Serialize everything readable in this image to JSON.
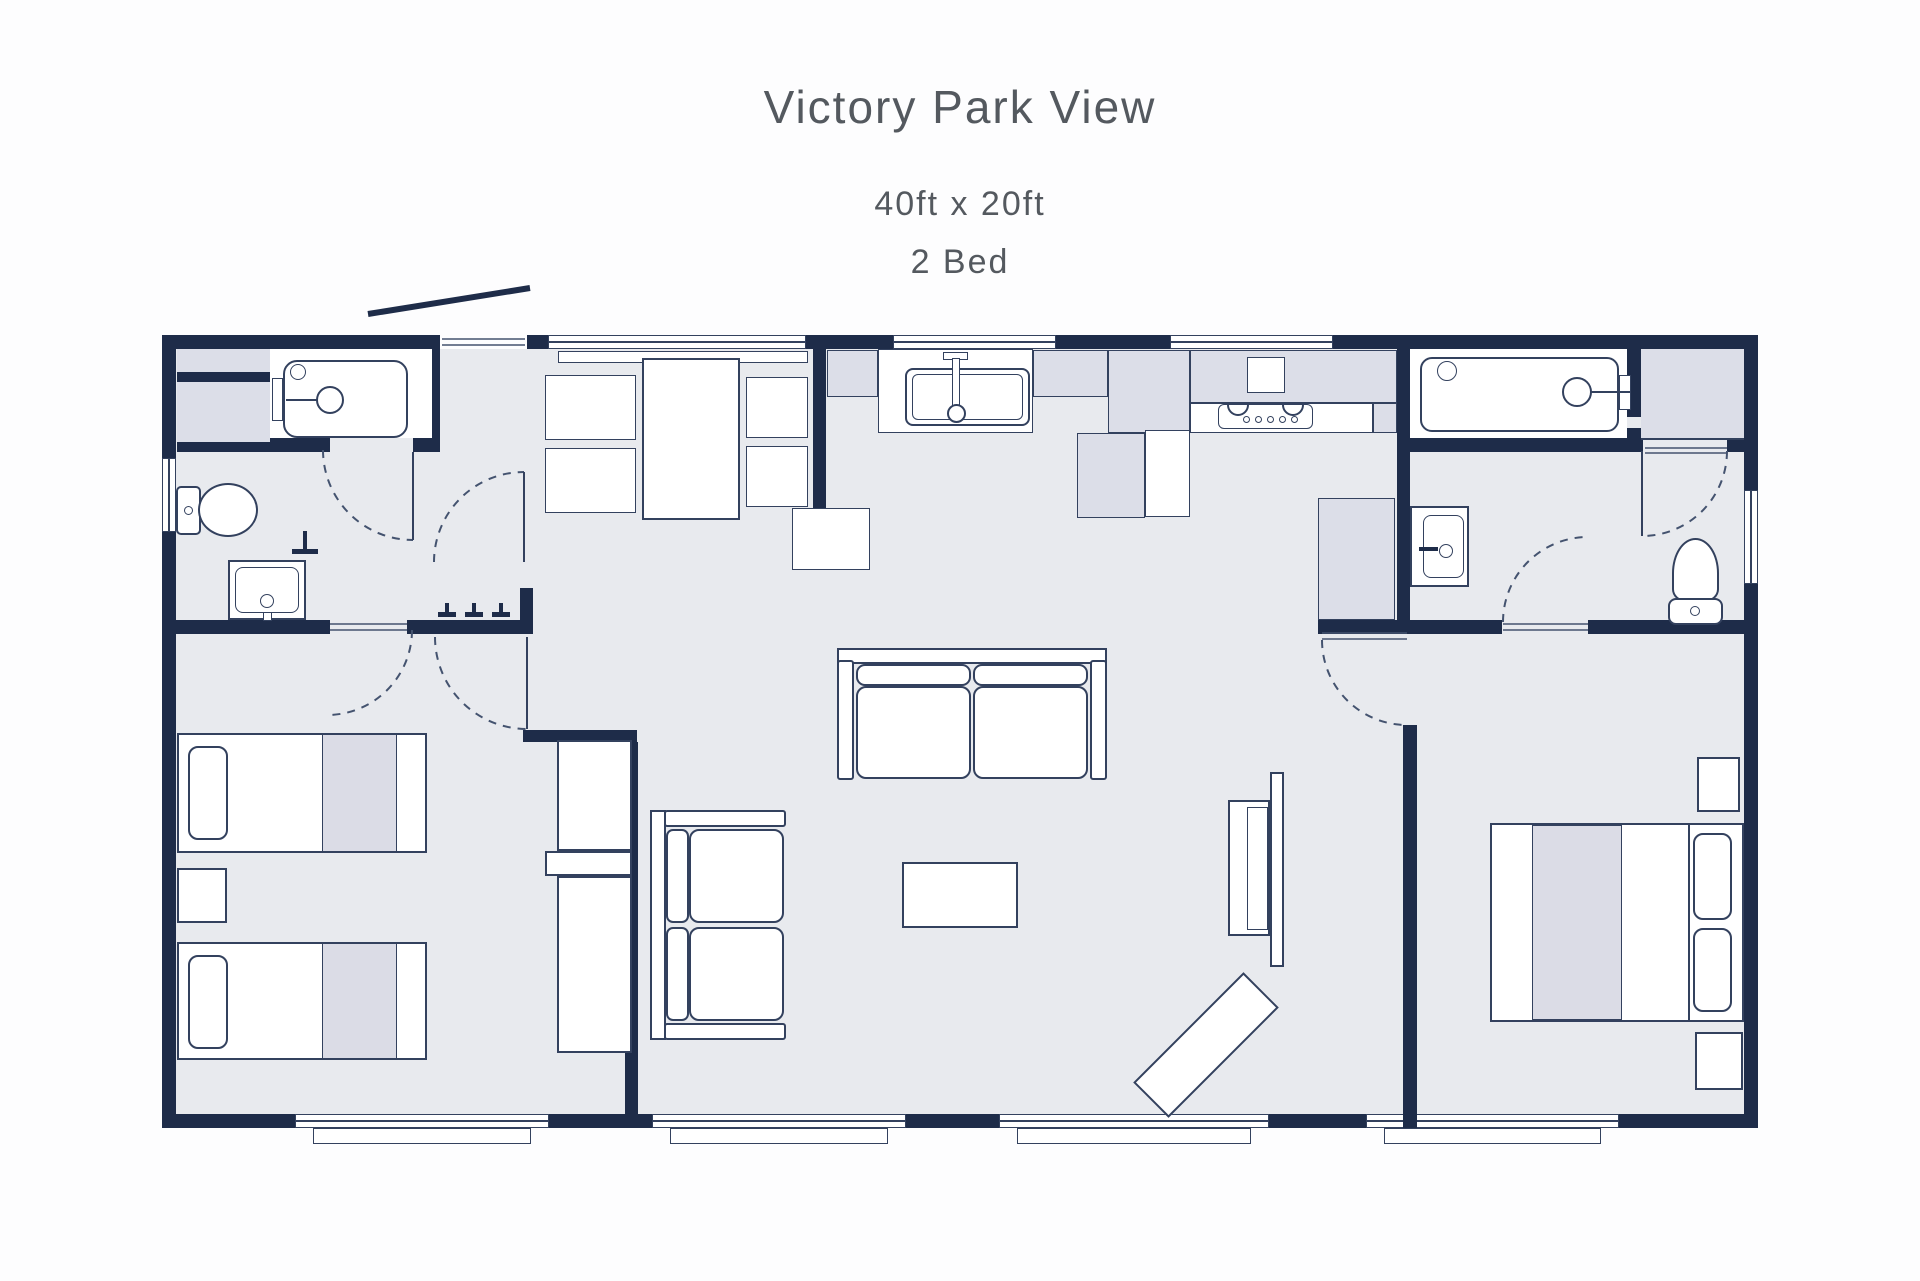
{
  "header": {
    "title": "Victory Park View",
    "dimensions": "40ft x 20ft",
    "bedrooms": "2 Bed"
  },
  "colors": {
    "wall": "#1e2c49",
    "outline": "#33415e",
    "floor": "#e8eaee",
    "cabinet_fill": "#dcdee8",
    "furniture_fill": "#ffffff",
    "text": "#54595f",
    "background": "#fdfdfe"
  }
}
